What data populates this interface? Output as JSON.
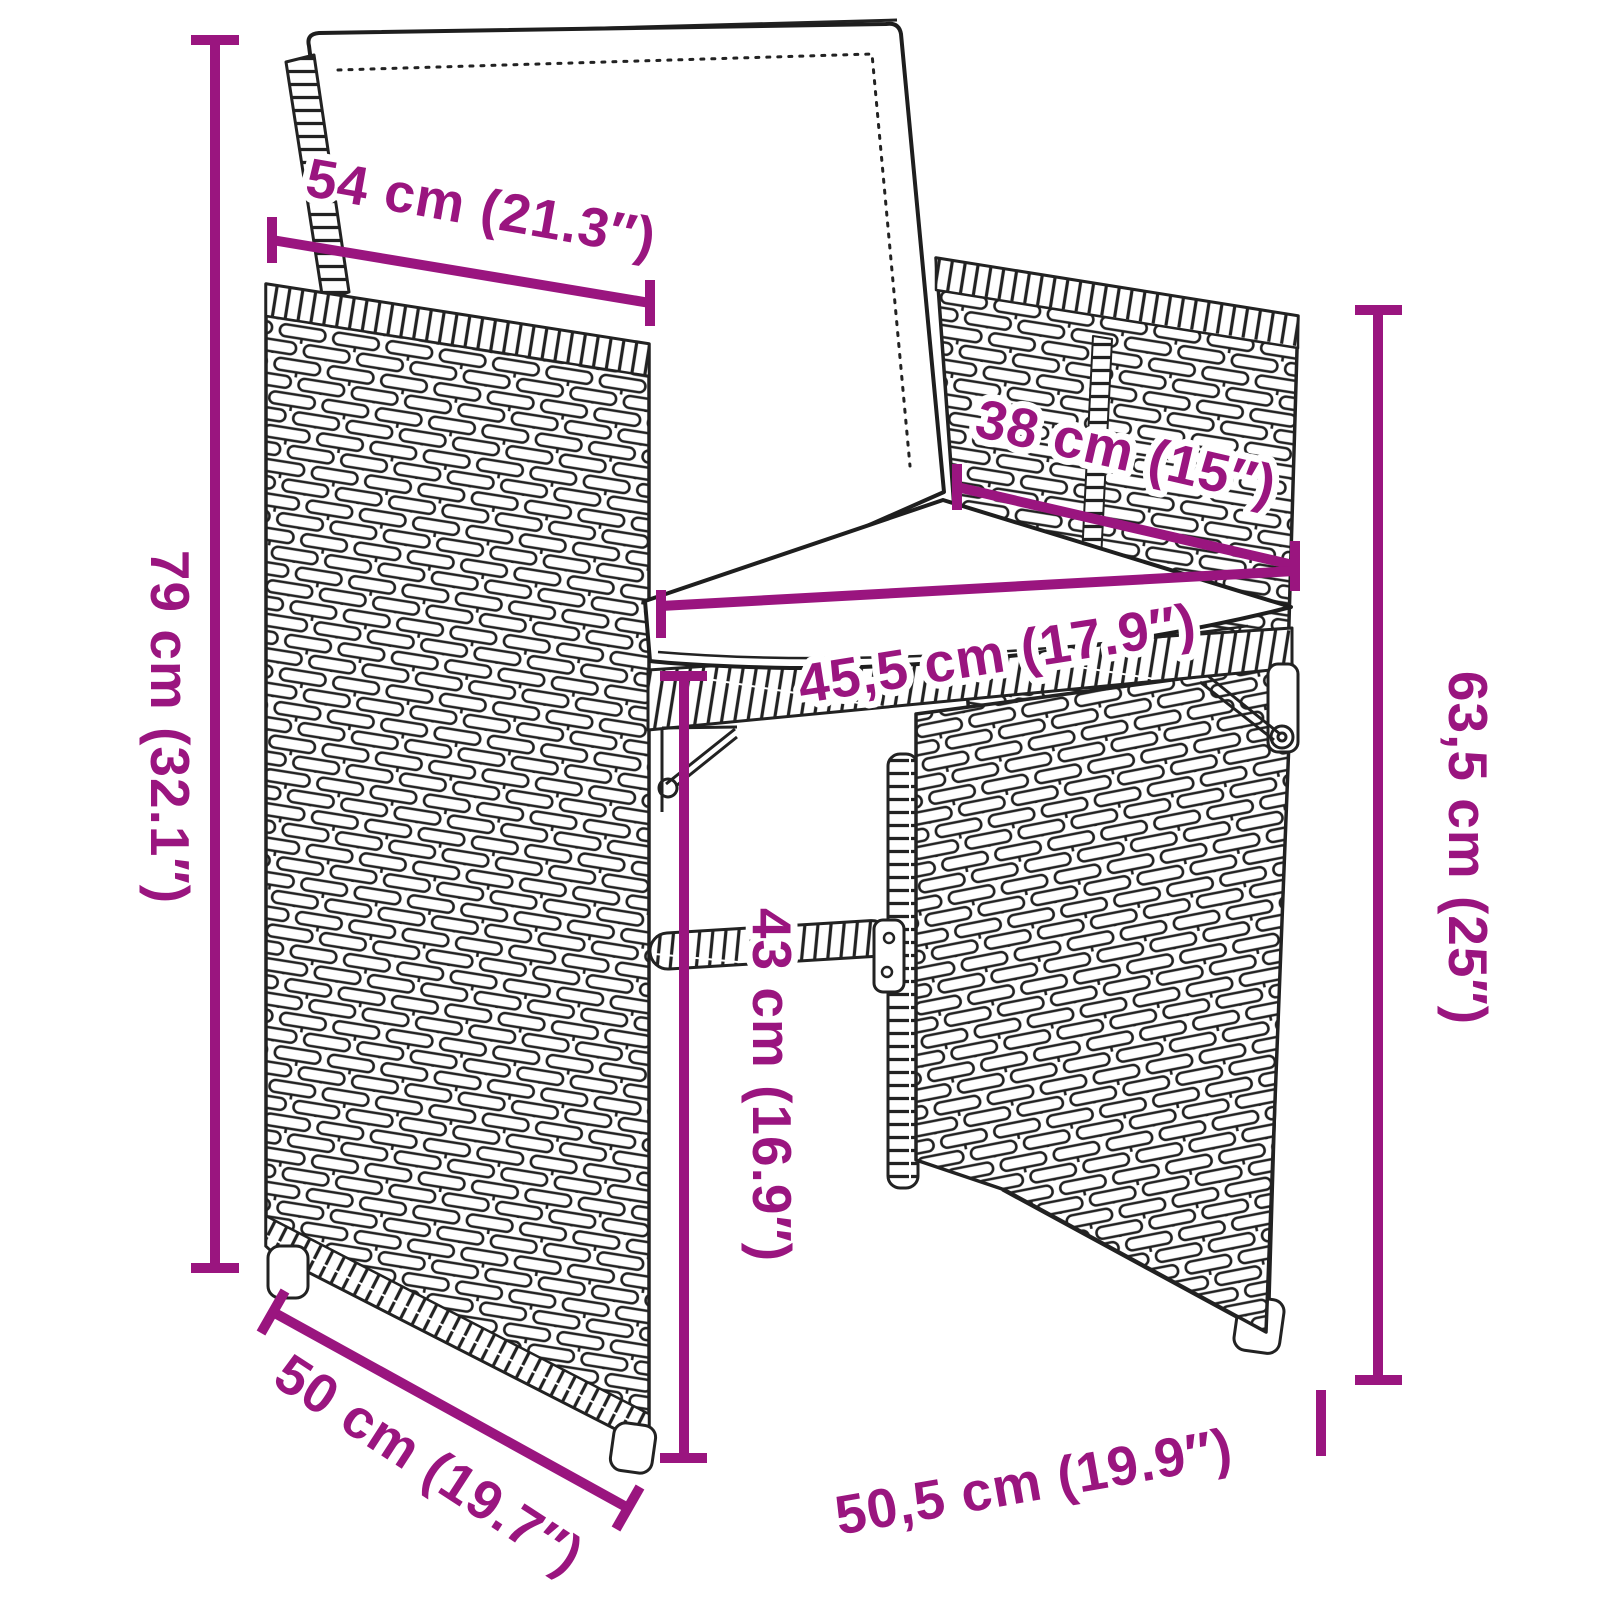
{
  "palette": {
    "accent": "#9a157f",
    "line_art": "#222222",
    "cushion": "#ffffff",
    "background": "#ffffff"
  },
  "subject": {
    "name": "poly-rattan armchair with seat and back cushions",
    "style": "black line-art product dimension diagram"
  },
  "dimensions": {
    "top_width": {
      "label": "54 cm (21.3″)"
    },
    "cushion_depth": {
      "label": "38 cm (15″)"
    },
    "overall_height": {
      "label": "79 cm (32.1″)"
    },
    "seat_width": {
      "label": "45,5 cm (17.9″)"
    },
    "back_height": {
      "label": "63,5 cm (25″)"
    },
    "seat_height": {
      "label": "43 cm (16.9″)"
    },
    "side_depth": {
      "label": "50 cm (19.7″)"
    },
    "overall_width": {
      "label": "50,5 cm (19.9″)"
    }
  }
}
